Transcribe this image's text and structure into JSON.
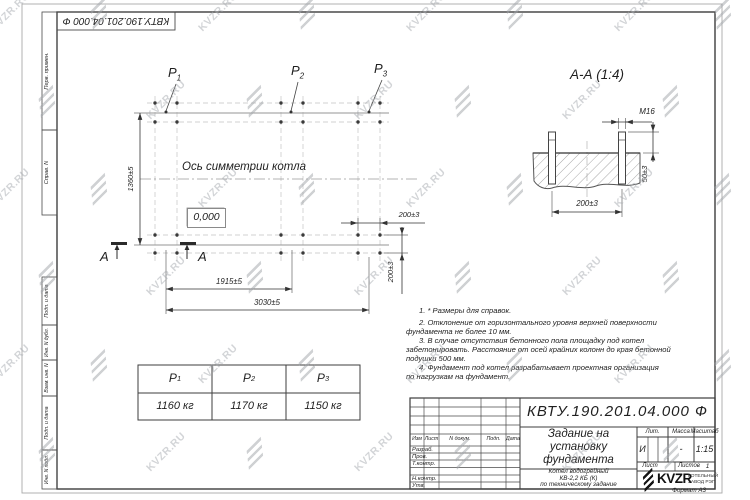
{
  "watermark": {
    "text": "KVZR.RU"
  },
  "corner_stamp": {
    "doc_number": "КВТУ.190.201.04.000  Ф"
  },
  "margin_stamps": [
    "Перв. примен.",
    "Справ. N",
    "Подп. и дата",
    "Инв. N дубл.",
    "Взам. инв. N",
    "Подп. и дата",
    "Инв. N подл."
  ],
  "plan": {
    "axis_label": "Ось симметрии котла",
    "level_mark": "0,000",
    "points": [
      {
        "p": "P",
        "sub": "1"
      },
      {
        "p": "P",
        "sub": "2"
      },
      {
        "p": "P",
        "sub": "3"
      }
    ],
    "dim_height": "1360±5",
    "dim_span_mid": "1915±5",
    "dim_span_full": "3030±5",
    "dim_bolt_x": "200±3",
    "dim_bolt_y": "200±3",
    "section_letter": "А"
  },
  "section_view": {
    "title": "А-А  (1:4)",
    "dim_thread": "M16",
    "dim_height": "50±3",
    "dim_spacing": "200±3"
  },
  "notes": {
    "lines": [
      "1. * Размеры для справок.",
      "2. Отклонение от горизонтального уровня верхней поверхности",
      "фундамента не более 10 мм.",
      "3. В случае отсутствия бетонного пола площадку под котел",
      "забетонировать. Расстояние от осей крайних колонн до края бетонной",
      "подушки 500 мм.",
      "4. Фундамент под котел разрабатывает проектная организация",
      "по нагрузкам на фундамент."
    ]
  },
  "load_table": {
    "headers": [
      {
        "p": "P",
        "sub": "1"
      },
      {
        "p": "P",
        "sub": "2"
      },
      {
        "p": "P",
        "sub": "3"
      }
    ],
    "values": [
      "1160 кг",
      "1170 кг",
      "1150 кг"
    ]
  },
  "title_block": {
    "doc_number": "КВТУ.190.201.04.000  Ф",
    "title_line1": "Задание на",
    "title_line2": "установку",
    "title_line3": "фундамента",
    "subtitle_line1": "Котел водогрейный",
    "subtitle_line2": "КВ-2,2 КБ (К)",
    "subtitle_line3": "по техническому задание",
    "col_izm": "Изм",
    "col_list": "Лист",
    "col_doc": "N докум.",
    "col_podp": "Подп.",
    "col_data": "Дата",
    "row_razrab": "Разраб.",
    "row_prov": "Пров.",
    "row_tkontr": "Т.контр.",
    "row_nkontr": "Н.контр.",
    "row_utv": "Утв.",
    "lit_label": "Лит.",
    "mass_label": "Масса",
    "scale_label": "Масштаб",
    "lit_value": "И",
    "mass_value": "-",
    "scale_value": "1:15",
    "sheet_label": "Лист",
    "sheets_label": "Листов",
    "sheets_value": "1",
    "brand": "KVZR",
    "brand_line1": "КОТЕЛЬНЫЙ",
    "brand_line2": "ЗАВОД РЭП"
  },
  "format_label": "Формат А3",
  "colors": {
    "ink": "#2b2b2b",
    "light_line": "#bdbdbd",
    "watermark": "#a7abb0"
  }
}
